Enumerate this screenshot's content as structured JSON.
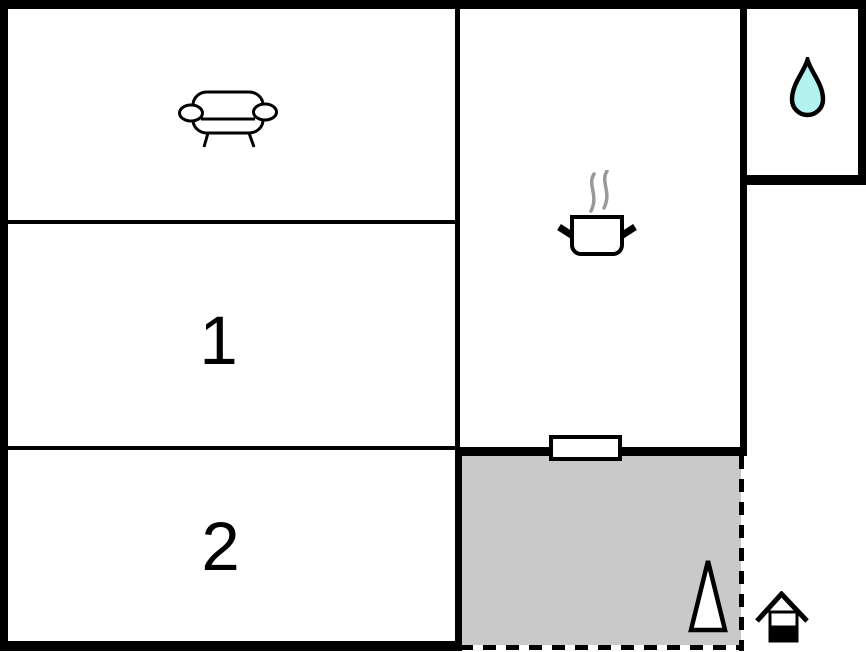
{
  "rooms": {
    "living_room": {
      "icon": "sofa-icon"
    },
    "bedroom_1": {
      "label": "1"
    },
    "bedroom_2": {
      "label": "2"
    },
    "kitchen": {
      "icon": "cooking-pot-icon"
    },
    "bathroom": {
      "icon": "water-drop-icon"
    },
    "terrace": {
      "icon": "conifer-tree-icon"
    },
    "exterior": {
      "icon": "house-entrance-icon"
    }
  },
  "symbols": {
    "window": "window-icon",
    "steam": "steam-icon"
  },
  "colors": {
    "wall": "#000000",
    "floor": "#ffffff",
    "terrace_fill": "#c9c9c9",
    "water_drop_fill": "#b4f2f0",
    "steam": "#999999",
    "icon_fill": "#ffffff",
    "outline": "#000000"
  }
}
